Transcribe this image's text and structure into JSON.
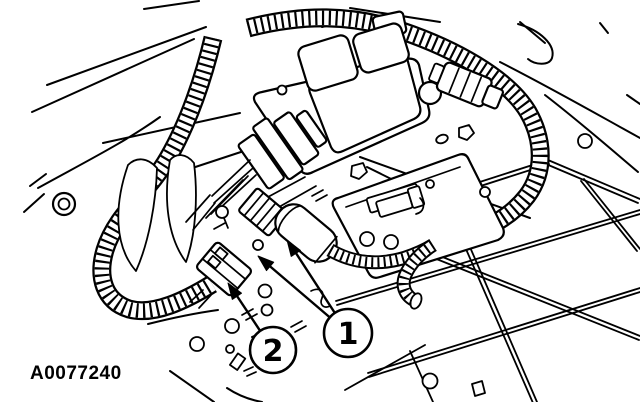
{
  "figure": {
    "id_label": "A0077240",
    "colors": {
      "line": "#000000",
      "background": "#ffffff"
    },
    "callouts": [
      {
        "number": "1",
        "cx": 348,
        "cy": 333,
        "r": 24,
        "arrow_tips": [
          [
            287,
            240
          ],
          [
            258,
            256
          ]
        ]
      },
      {
        "number": "2",
        "cx": 273,
        "cy": 350,
        "r": 23,
        "arrow_tips": [
          [
            228,
            283
          ]
        ]
      }
    ]
  }
}
